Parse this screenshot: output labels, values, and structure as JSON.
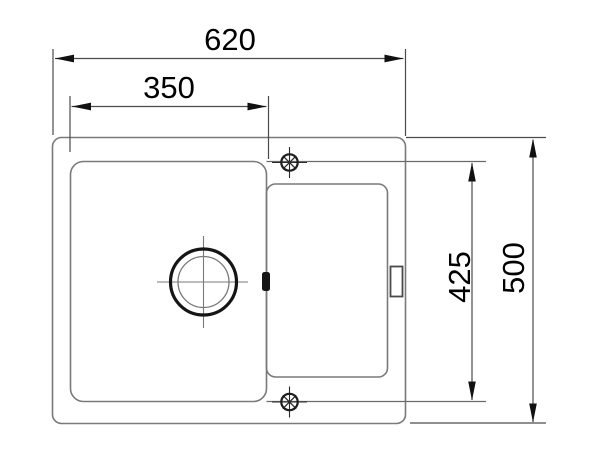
{
  "drawing": {
    "type": "technical-dimension-drawing",
    "subject": "inset kitchen sink with left bowl and right drainer, top view",
    "units": "mm",
    "dim_overall_width": {
      "label": "620"
    },
    "dim_bowl_width": {
      "label": "350"
    },
    "dim_inner_depth": {
      "label": "425"
    },
    "dim_overall_depth": {
      "label": "500"
    },
    "colors": {
      "background": "#ffffff",
      "outline": "#7a7a7a",
      "dimension_line": "#4a4a4a",
      "bold_feature": "#151515",
      "text": "#000000"
    }
  }
}
